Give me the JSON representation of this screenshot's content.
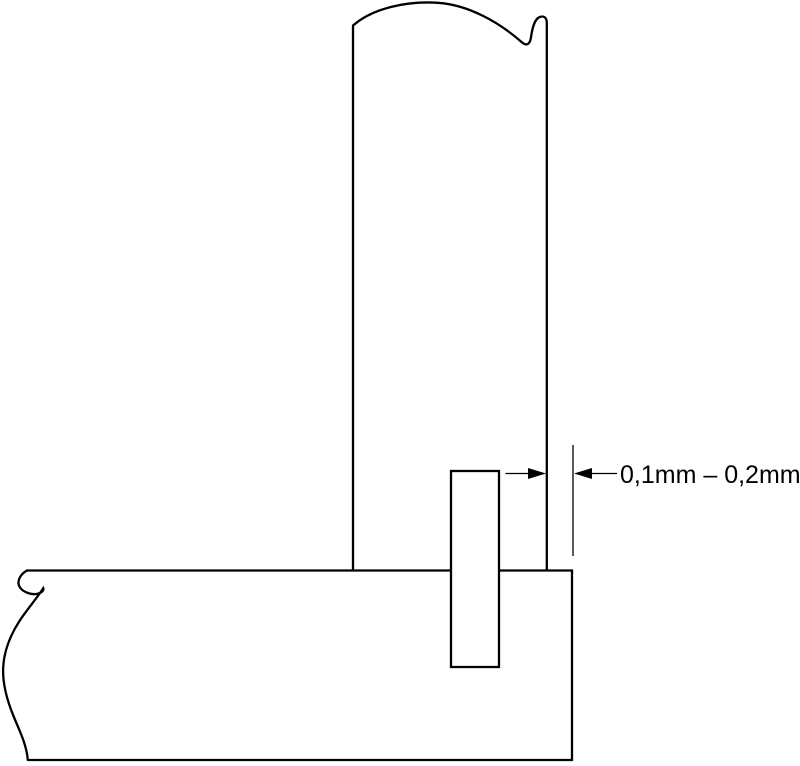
{
  "drawing": {
    "kind": "technical-section-diagram",
    "dimension": {
      "label": "0,1mm – 0,2mm"
    },
    "colors": {
      "line": "#000000",
      "background": "#ffffff"
    }
  }
}
